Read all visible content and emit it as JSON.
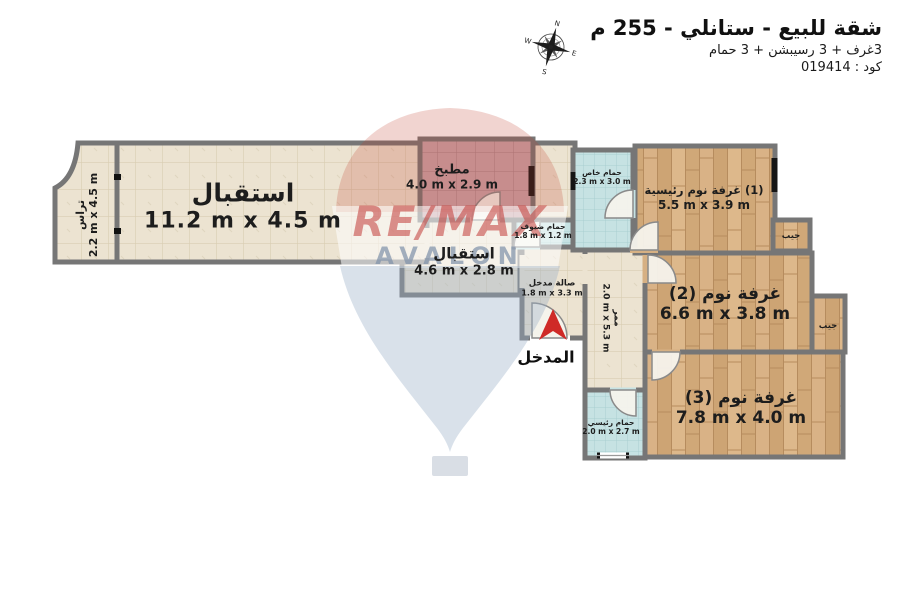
{
  "header": {
    "title": "شقة للبيع - ستانلي - 255 م",
    "subtitle": "3غرف + 3 رسيبشن + 3 حمام",
    "code": "كود : 019414"
  },
  "compass": {
    "n": "N",
    "e": "E",
    "s": "S",
    "w": "W"
  },
  "entrance": {
    "label": "المدخل"
  },
  "rooms": [
    {
      "id": "terrace",
      "name": "تراس",
      "dims": "2.2 m x 4.5 m"
    },
    {
      "id": "reception-main",
      "name": "استقبال",
      "dims": "11.2 m x 4.5 m"
    },
    {
      "id": "kitchen",
      "name": "مطبخ",
      "dims": "4.0 m x 2.9 m"
    },
    {
      "id": "reception-2",
      "name": "استقبال",
      "dims": "4.6 m x 2.8 m"
    },
    {
      "id": "guest-bath",
      "name": "حمام ضيوف",
      "dims": "1.8 m x 1.2 m"
    },
    {
      "id": "entry-hall",
      "name": "صالة مدخل",
      "dims": "1.8 m x 3.3 m"
    },
    {
      "id": "private-bath",
      "name": "حمام خاص",
      "dims": "2.3 m x 3.0 m"
    },
    {
      "id": "master-bedroom",
      "name": "(1) غرفة نوم رئيسية",
      "dims": "5.5 m x 3.9 m"
    },
    {
      "id": "corridor",
      "name": "ممر",
      "dims": "2.0 m x 5.3 m"
    },
    {
      "id": "bedroom-2",
      "name": "غرفة نوم (2)",
      "dims": "6.6 m x 3.8 m"
    },
    {
      "id": "closet-1",
      "name": "جيب",
      "dims": ""
    },
    {
      "id": "closet-2",
      "name": "جيب",
      "dims": ""
    },
    {
      "id": "bedroom-3",
      "name": "غرفة نوم (3)",
      "dims": "7.8 m x 4.0 m"
    },
    {
      "id": "main-bath",
      "name": "حمام رئيسي",
      "dims": "2.0 m x 2.7 m"
    }
  ],
  "watermark": {
    "line1": "RE/MAX",
    "line2": "AVALON"
  },
  "colors": {
    "arrow_red": "#cf2a27",
    "wall_gray": "#767676",
    "floor_tile_beige": "#ece3d1",
    "floor_kitchen_pink": "#c9a5a9",
    "floor_bath_blue": "#c6e2e3",
    "floor_wood": "#d6b083",
    "watermark_red": "#c13b36",
    "watermark_blue": "#9cb0c7"
  }
}
